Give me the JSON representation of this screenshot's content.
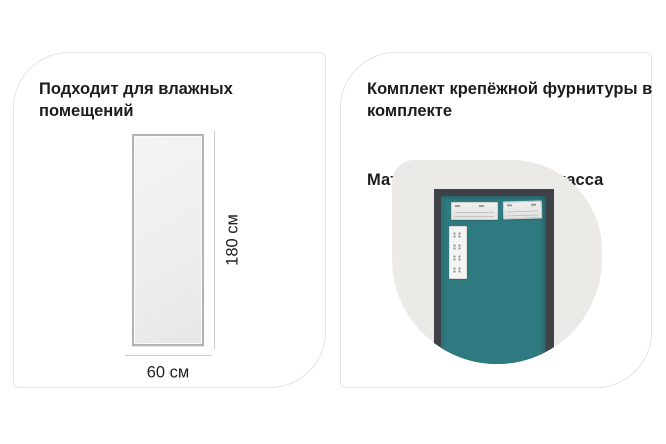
{
  "page": {
    "background": "#ffffff",
    "description": "product-infographic-two-cards"
  },
  "colors": {
    "teal_door": "#2F7A80",
    "door_frame": "#3E4146",
    "photo_blob_bg": "#ECEAE7",
    "card_border": "#E5E5E5",
    "text": "#1C1C1E",
    "measure_line": "#CDCDCD"
  },
  "left_card": {
    "title": "Подходит для влажных помещений",
    "mirror_diagram": {
      "height_label": "180 см",
      "width_label": "60 см"
    }
  },
  "right_card": {
    "title": "Комплект крепёжной фурнитуры в комплекте",
    "subtitle": "Материал рамы: пластмасса"
  }
}
